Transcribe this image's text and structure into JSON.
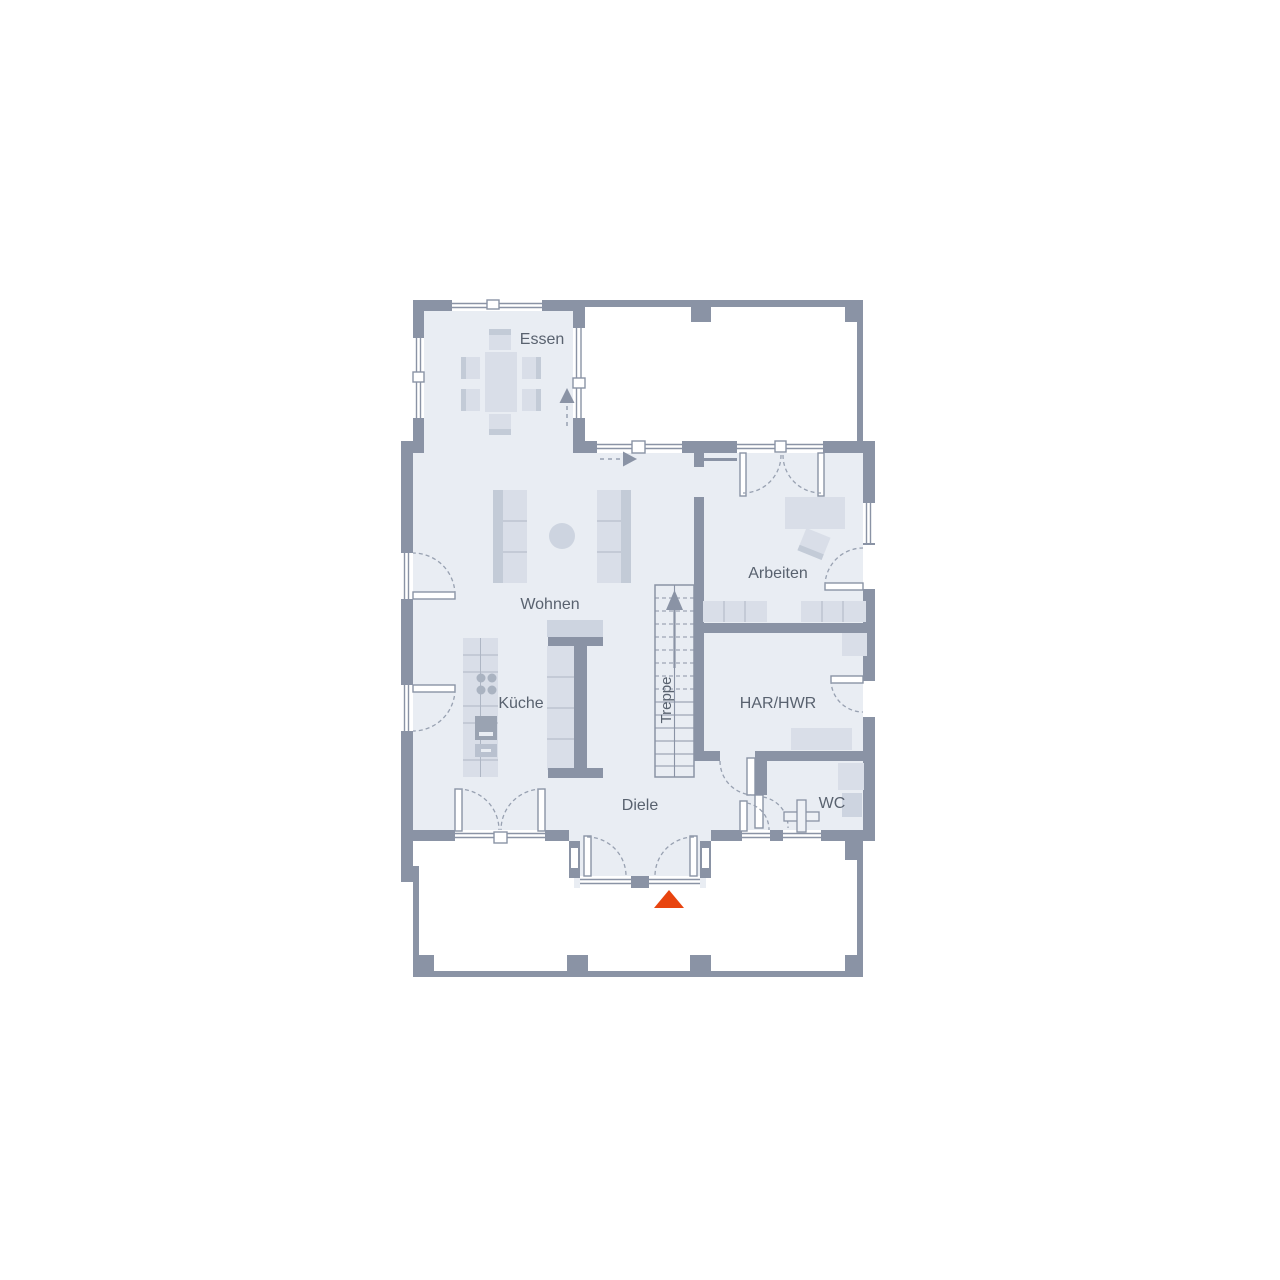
{
  "rooms": {
    "essen": {
      "label": "Essen"
    },
    "wohnen": {
      "label": "Wohnen"
    },
    "kueche": {
      "label": "Küche"
    },
    "arbeiten": {
      "label": "Arbeiten"
    },
    "har_hwr": {
      "label": "HAR/HWR"
    },
    "treppe": {
      "label": "Treppe"
    },
    "diele": {
      "label": "Diele"
    },
    "wc": {
      "label": "WC"
    }
  },
  "palette": {
    "wall": "#8a93a5",
    "floor": "#e9edf3",
    "furniture": "#d9dee8",
    "entrance_marker": "#e8440f",
    "label_text": "#59626f"
  },
  "markers": {
    "entrance_symbol": "triangle-up",
    "stair_direction": "up"
  }
}
